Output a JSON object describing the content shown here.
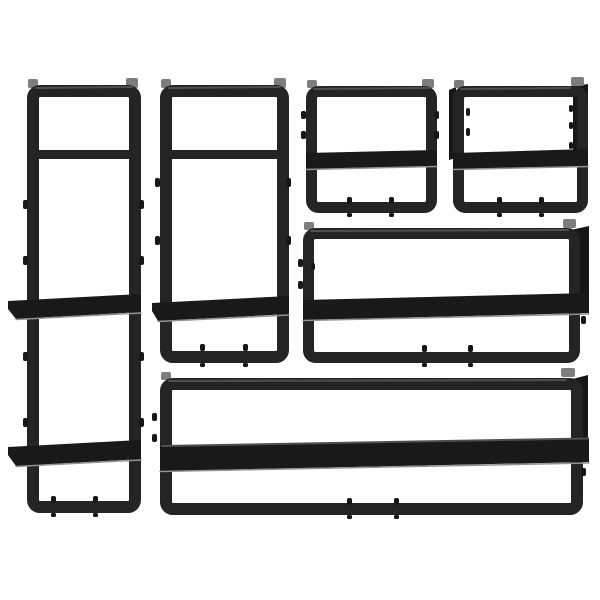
{
  "scene": {
    "description": "Product photo of a 6-piece black metal wall-mounted shelf set on a plain white background",
    "piece_count": 6,
    "background_color": "#ffffff"
  },
  "colors": {
    "frame": "#242424",
    "frame-dark": "#161616",
    "shelf": "#191919",
    "highlight": "#4f4f4f",
    "tab": "#7d7d7d",
    "underline": "#929292",
    "background": "#ffffff"
  },
  "items": [
    {
      "id": "tall-shelf-left",
      "label": "Tall narrow wall shelf unit with two boards (far left)"
    },
    {
      "id": "tall-shelf-middle",
      "label": "Tall narrow wall shelf unit with one board (middle left)"
    },
    {
      "id": "small-shelf-left",
      "label": "Small square wall shelf (top middle)"
    },
    {
      "id": "small-shelf-right",
      "label": "Small square wall shelf (top right)"
    },
    {
      "id": "wide-shelf-middle",
      "label": "Wide wall shelf with bar (middle right)"
    },
    {
      "id": "wide-shelf-bottom",
      "label": "Extra wide wall shelf with bar (bottom)"
    }
  ]
}
